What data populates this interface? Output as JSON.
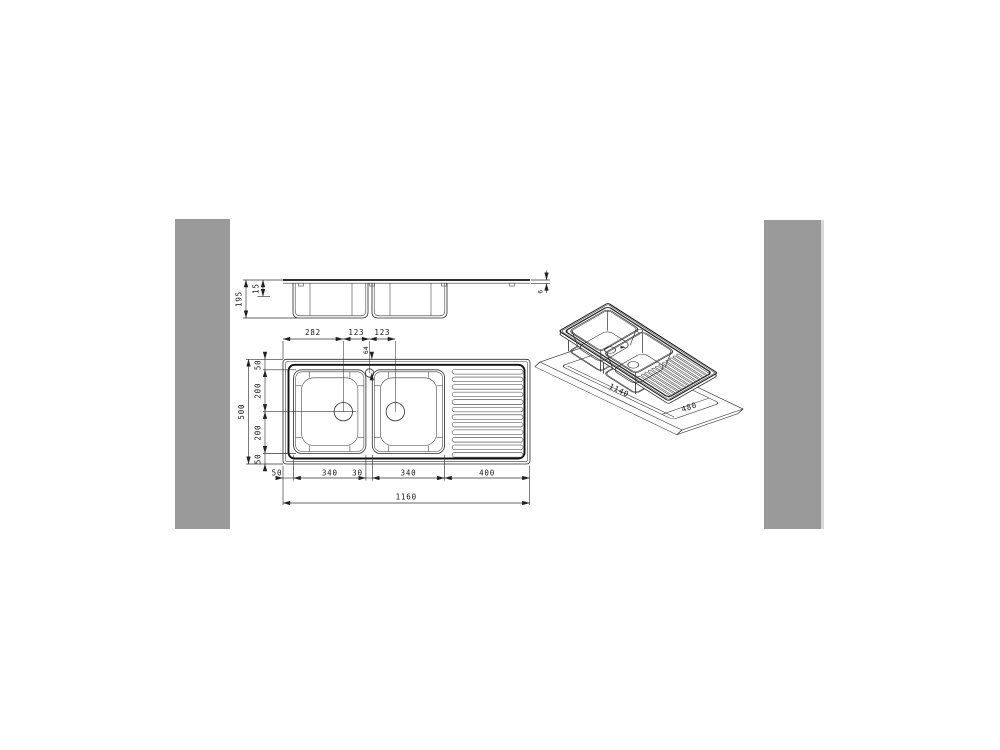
{
  "side_view": {
    "total_depth": "195",
    "rim_depth": "15",
    "deck_thickness": "6"
  },
  "plan_view": {
    "top": [
      "282",
      "123",
      "123"
    ],
    "tap_offset": "64",
    "left": [
      "50",
      "200",
      "200",
      "50"
    ],
    "left_total": "500",
    "bottom": [
      "50",
      "340",
      "30",
      "340",
      "400"
    ],
    "bottom_total": "1160"
  },
  "iso_view": {
    "cutout_length": "1140",
    "cutout_width": "480"
  },
  "colors": {
    "panel_gray": "#9a9a9a",
    "line": "#2a2a2a",
    "text": "#151515",
    "background": "#ffffff"
  }
}
